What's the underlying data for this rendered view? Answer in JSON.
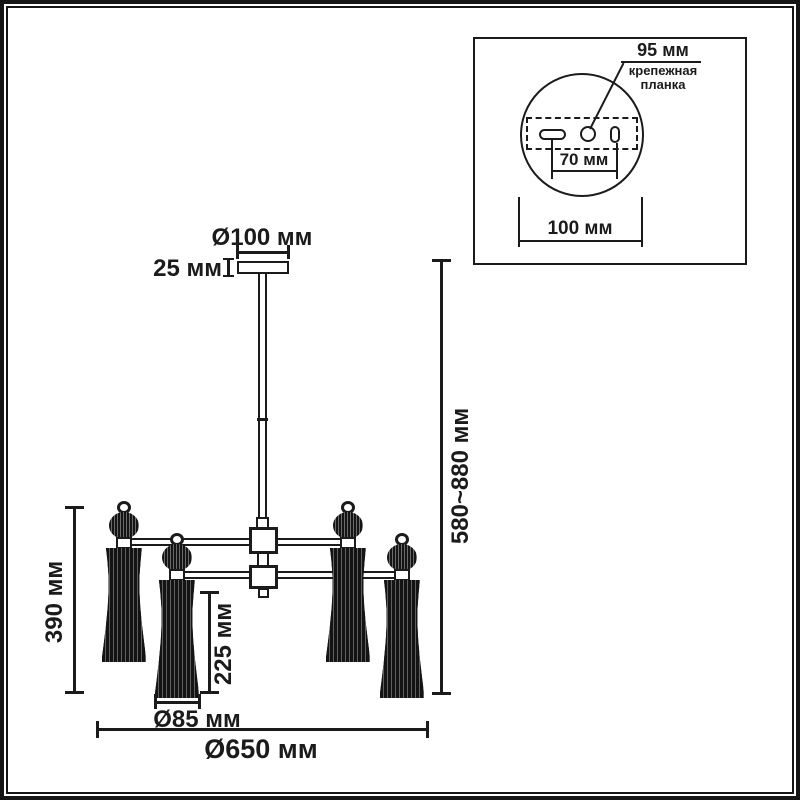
{
  "colors": {
    "ink": "#1b1b1b",
    "background": "#ffffff"
  },
  "main_view": {
    "dim_canopy_diameter": "Ø100 мм",
    "dim_canopy_height": "25 мм",
    "dim_overall_height": "580~880 мм",
    "dim_lamp_height": "390 мм",
    "dim_shade_height": "225 мм",
    "dim_shade_diameter": "Ø85 мм",
    "dim_overall_diameter": "Ø650 мм"
  },
  "inset_view": {
    "dim_plate_length": "95 мм",
    "label_plate_line1": "крепежная",
    "label_plate_line2": "планка",
    "dim_hole_spacing": "70 мм",
    "dim_canopy_diameter": "100 мм"
  }
}
